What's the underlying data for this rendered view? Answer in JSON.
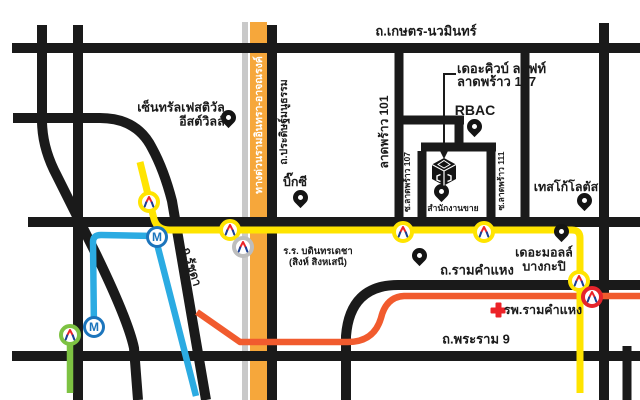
{
  "map": {
    "roads": {
      "kaset_nawamin": "ถ.เกษตร-นวมินทร์",
      "expressway": "ทางด่วนรามอินทรา-อาจณรงค์",
      "pradit_manutham": "ถ.ประดิษฐ์มนูธรรม",
      "ladprao_101": "ลาดพร้าว 101",
      "soi_ladprao_107": "ซ.ลาดพร้าว 107",
      "soi_ladprao_111": "ซ.ลาดพร้าว 111",
      "ratchada": "ถ.รัชดา",
      "ramkhamhaeng": "ถ.รามคำแหง",
      "rama_9": "ถ.พระราม 9"
    },
    "places": {
      "central_festival": {
        "line1": "เซ็นทรัลเฟสติวัล",
        "line2": "อีสต์วิลล์"
      },
      "big_c": "บิ๊กซี",
      "rbac": "RBAC",
      "destination": {
        "line1": "เดอะคิวบ์ ลอฟท์",
        "line2": "ลาดพร้าว 107"
      },
      "sales_office": "สำนักงานขาย",
      "tesco_lotus": "เทสโก้โลตัส",
      "school": {
        "line1": "ร.ร. บดินทรเดชา",
        "line2": "(สิงห์ สิงหเสนี)"
      },
      "the_mall": {
        "line1": "เดอะมอลล์",
        "line2": "บางกะปิ"
      },
      "hospital": "รพ.รามคำแหง"
    },
    "transit": {
      "metro_badge": "M",
      "lines": [
        {
          "name": "yellow-line",
          "color": "#FFE400"
        },
        {
          "name": "blue-line",
          "color": "#2BABE2"
        },
        {
          "name": "green-line",
          "color": "#7DC242"
        },
        {
          "name": "orange-line",
          "color": "#F15B2E"
        }
      ]
    },
    "colors": {
      "road": "#1A1A1A",
      "expressway_fill": "#F6A73B",
      "expressway_median": "#C9C9C9",
      "metro_blue": "#1C75BC",
      "station_red_ring": "#E5242C",
      "station_gray_ring": "#BDBDBD",
      "station_green_ring": "#7DC242",
      "mrta_logo_red": "#EC2227",
      "mrta_logo_blue": "#1B3F95",
      "hospital_cross": "#EC2227"
    }
  }
}
